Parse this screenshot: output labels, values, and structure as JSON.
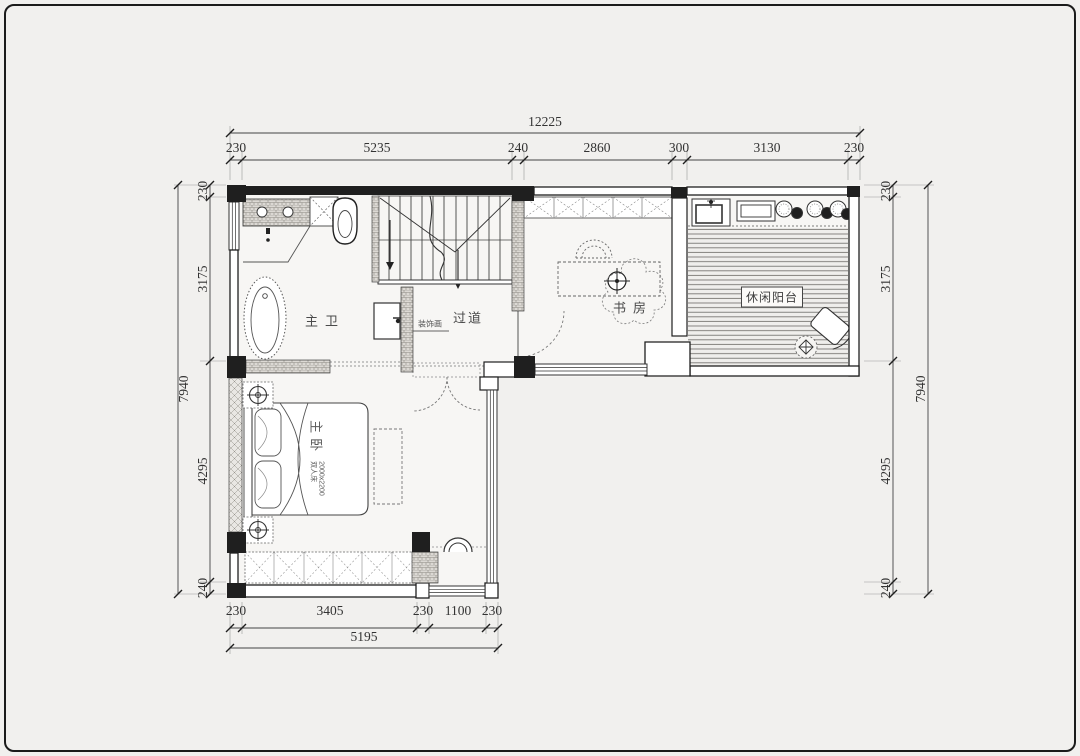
{
  "colors": {
    "background": "#f1f0ee",
    "ink": "#1f1f1f",
    "dim_text": "#333333"
  },
  "dimensions": {
    "top": {
      "total": "12225",
      "segments": [
        "230",
        "5235",
        "240",
        "2860",
        "300",
        "3130",
        "230"
      ]
    },
    "bottom": {
      "total": "5195",
      "segments": [
        "230",
        "3405",
        "230",
        "1100",
        "230"
      ]
    },
    "left": {
      "total": "7940",
      "segments": [
        "230",
        "3175",
        "4295",
        "240"
      ]
    },
    "right": {
      "total": "7940",
      "segments": [
        "230",
        "3175",
        "4295",
        "240"
      ]
    }
  },
  "rooms": {
    "master_bath": "主卫",
    "hallway": "过道",
    "study": "书房",
    "leisure_balcony": "休闲阳台",
    "master_bedroom": "主卧"
  },
  "annotations": {
    "decor_painting": "装饰画",
    "bed_size": "2000x2200",
    "bed_type": "双人床"
  }
}
